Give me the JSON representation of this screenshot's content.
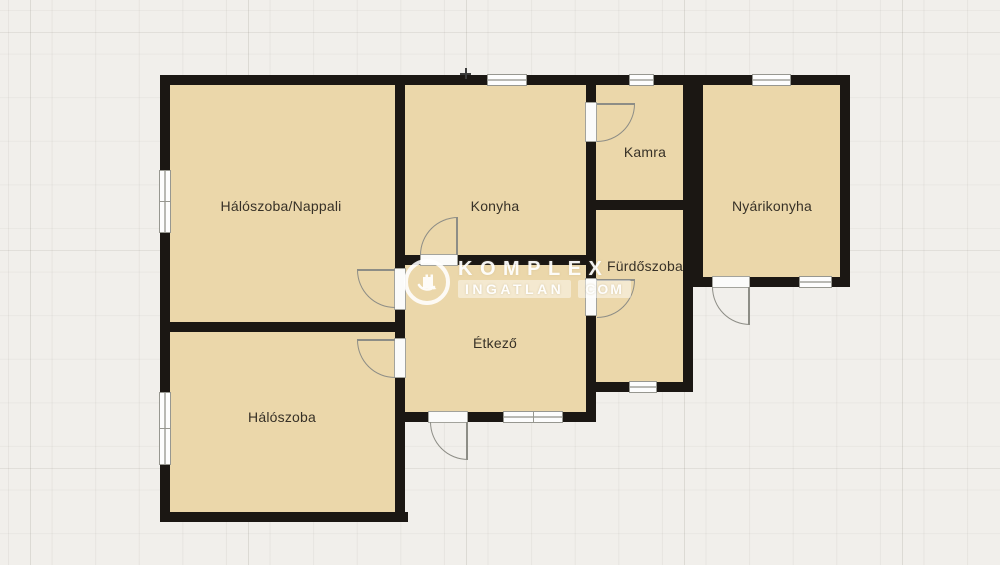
{
  "floorplan": {
    "type": "floor-plan",
    "rooms": [
      {
        "label": "Hálószoba/Nappali"
      },
      {
        "label": "Konyha"
      },
      {
        "label": "Kamra"
      },
      {
        "label": "Nyárikonyha"
      },
      {
        "label": "Fürdőszoba"
      },
      {
        "label": "Étkező"
      },
      {
        "label": "Hálószoba"
      }
    ],
    "colors": {
      "room_fill": "#ebd7aa",
      "wall": "#1b1713",
      "background": "#f1efeb",
      "window": "#fdfdfd",
      "frame": "#979790"
    }
  },
  "watermark": {
    "brand": "KOMPLEX",
    "brand_sub": "INGATLAN",
    "brand_tld": "COM"
  }
}
